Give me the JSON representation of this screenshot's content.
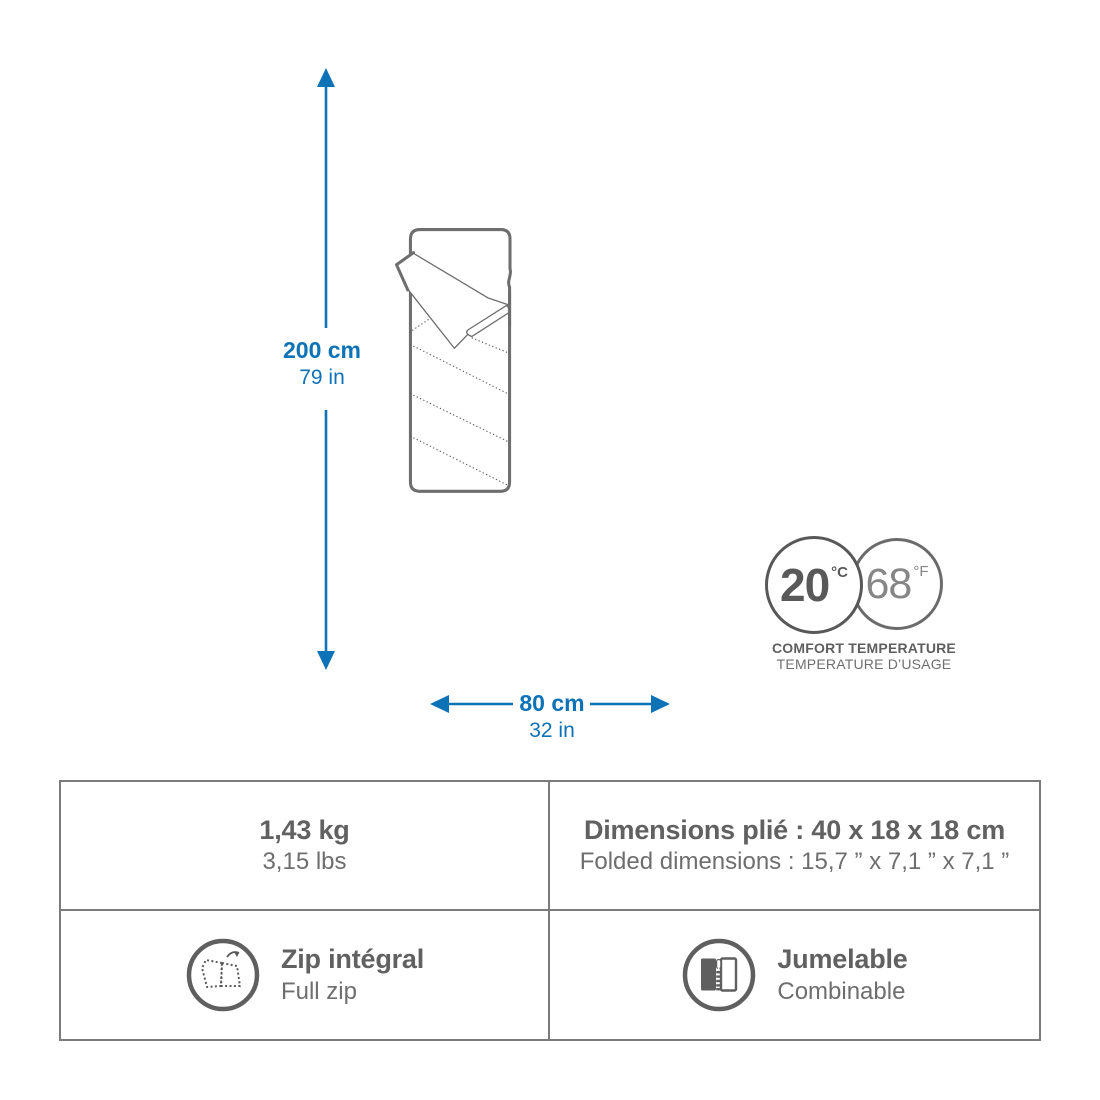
{
  "illustration": {
    "product": "sleeping-bag",
    "height_dimension": {
      "metric": "200 cm",
      "imperial": "79 in"
    },
    "width_dimension": {
      "metric": "80 cm",
      "imperial": "32 in"
    },
    "temperature": {
      "celsius_value": "20",
      "celsius_unit": "°C",
      "fahrenheit_value": "68",
      "fahrenheit_unit": "°F",
      "label_line1": "COMFORT TEMPERATURE",
      "label_line2": "TEMPERATURE D’USAGE"
    }
  },
  "spec_table": {
    "weight": {
      "primary": "1,43 kg",
      "secondary": "3,15 lbs"
    },
    "folded": {
      "primary": "Dimensions plié : 40 x 18 x 18 cm",
      "secondary": "Folded dimensions : 15,7 ” x 7,1 ” x 7,1 ”"
    },
    "zip": {
      "primary": "Zip intégral",
      "secondary": "Full zip",
      "icon": "full-zip-open-icon"
    },
    "pairing": {
      "primary": "Jumelable",
      "secondary": "Combinable",
      "icon": "twin-combinable-zip-icon"
    }
  },
  "colors": {
    "accent_blue": "#0d72b6",
    "line_gray": "#6e6e6e",
    "text_gray": "#616161"
  }
}
